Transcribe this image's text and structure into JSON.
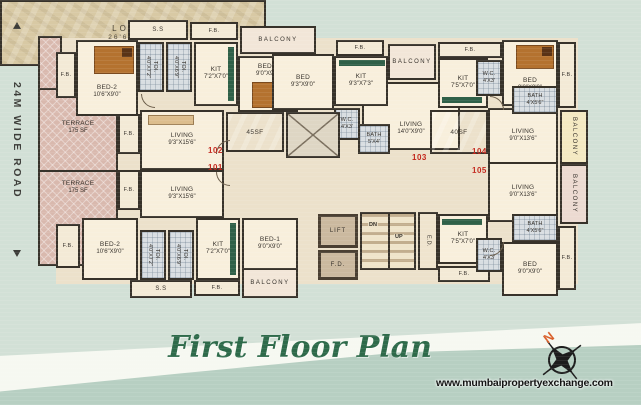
{
  "page": {
    "title": "First Floor Plan",
    "watermark": "www.mumbaipropertyexchange.com",
    "compass_north": "N",
    "road_label": "24M WIDE ROAD"
  },
  "units": {
    "u101": "101",
    "u102": "102",
    "u103": "103",
    "u104": "104",
    "u105": "105"
  },
  "labels": {
    "fb": "F.B.",
    "ss": "S.S",
    "balcony": "BALCONY",
    "lift": "LIFT",
    "fd": "F.D.",
    "ed": "E.D.",
    "dn": "DN",
    "up": "UP",
    "sf45": "45SF",
    "sf40": "40SF"
  },
  "rooms": {
    "terrace": {
      "name": "TERRACE",
      "dims": "175 SF"
    },
    "bed2": {
      "name": "BED-2",
      "dims": "10'6\"X9'0\""
    },
    "bed1": {
      "name": "BED-1",
      "dims": "9'0\"X9'0\""
    },
    "bed_93x90": {
      "name": "BED",
      "dims": "9'3\"X9'0\""
    },
    "bed_90x90": {
      "name": "BED",
      "dims": "9'0\"X9'0\""
    },
    "kit_72x70": {
      "name": "KIT",
      "dims": "7'2\"X7'0\""
    },
    "kit_93x73": {
      "name": "KIT",
      "dims": "9'3\"X7'3\""
    },
    "kit_75x70": {
      "name": "KIT",
      "dims": "7'5\"X7'0\""
    },
    "living_93x156": {
      "name": "LIVING",
      "dims": "9'3\"X15'6\""
    },
    "living_140x90": {
      "name": "LIVING",
      "dims": "14'0\"X9'0\""
    },
    "living_90x136": {
      "name": "LIVING",
      "dims": "9'0\"X13'6\""
    },
    "bath_4x56": {
      "name": "BATH",
      "dims": "4'X5'6\""
    },
    "bath_5x4": {
      "name": "BATH",
      "dims": "5'X4'"
    },
    "wc": {
      "name": "W.C.",
      "dims": "4'X3'"
    },
    "toi_a": {
      "name": "TOI.",
      "dims": "4'0\"X7'2\""
    },
    "toi_b": {
      "name": "TOI.",
      "dims": "4'0\"X6'9\""
    },
    "lobby": {
      "name": "LOBBY",
      "dims": "26'6\"X8'3\""
    }
  }
}
